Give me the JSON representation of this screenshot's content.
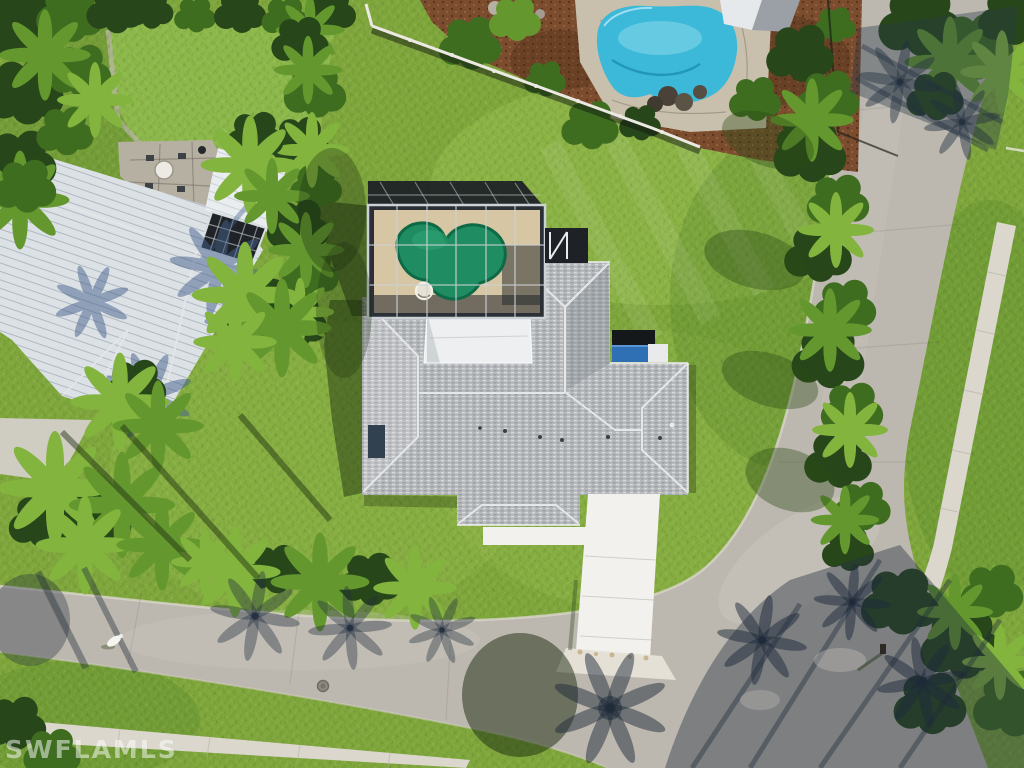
{
  "image": {
    "type": "aerial-drone-photo",
    "width": 1024,
    "height": 768,
    "subject": "single-family home with screened green pool enclosure on a corner lot along a curved street"
  },
  "watermark": {
    "text": "SWFLAMLS"
  },
  "colors": {
    "lawn_base": "#7fa63c",
    "lawn_light": "#97bd4e",
    "lawn_dark": "#55832a",
    "lawn_shadow": "#2c4b17",
    "neighbor_lawn": "#8cb74a",
    "road": "#bdb8af",
    "road_light": "#cdc9c0",
    "shadow_blue": "#44618c",
    "sidewalk": "#dbd7cc",
    "driveway": "#f2f1ed",
    "concrete": "#cfccc2",
    "roof_shingle": "#b7babd",
    "roof_shade": "#9ba0a5",
    "roof_ridge": "#e4e6e8",
    "roof_white": "#edeff0",
    "metal_roof": "#dce1e5",
    "pergola_dark": "#22272b",
    "screen_dark": "#2b3036",
    "screen_frame": "#ccd1d5",
    "pool_deck": "#d7c6a3",
    "pool_green": "#1f8c61",
    "pool_green_dark": "#0e6a46",
    "spa": "#e7e1d3",
    "neighbor_pool": "#3cb9d9",
    "neighbor_pool_light": "#8edcec",
    "stone": "#c8bfac",
    "mulch": "#7b4d2e",
    "tree_dark": "#27471a",
    "tree_mid": "#3f6d20",
    "tree_light": "#64982f",
    "palm_bright": "#83b43e",
    "fence_white": "#ebe9e2",
    "watermark": "#ffffff"
  },
  "scene": {
    "subject_property": {
      "roof": "gray asphalt-shingle hip roof with white ridge caps and flat white lanai roof section",
      "pool_enclosure": "black screened lanai with aluminum frame grid, tan deck, green freeform pool and small spa",
      "driveway": "bright white concrete driveway and front walkway meeting the street",
      "lawn": "large open green lawn on a corner lot"
    },
    "left_neighbor": {
      "roof": "white standing-seam metal roof with palm-frond shadows",
      "patio": "stone patio with round table and chairs",
      "pergola": "dark slatted pergola grid"
    },
    "top_neighbor": {
      "pool": "blue freeform pool with stone coping and rock waterfall",
      "landscape": "brown mulch beds with shrubs",
      "fence": "white-railed fence on the shared property line"
    },
    "street": {
      "surface": "light gray street curving from top right to bottom left",
      "sidewalk": "concrete sidewalk strips along the far side and bottom left",
      "manhole": "manhole cover in lower roadway"
    },
    "details": {
      "white_bird": "small white bird on road at bottom left",
      "mailbox": "mailbox at the curve casting a long shadow",
      "tree_shadows": "long palm and tree shadows across road and lawns"
    }
  }
}
